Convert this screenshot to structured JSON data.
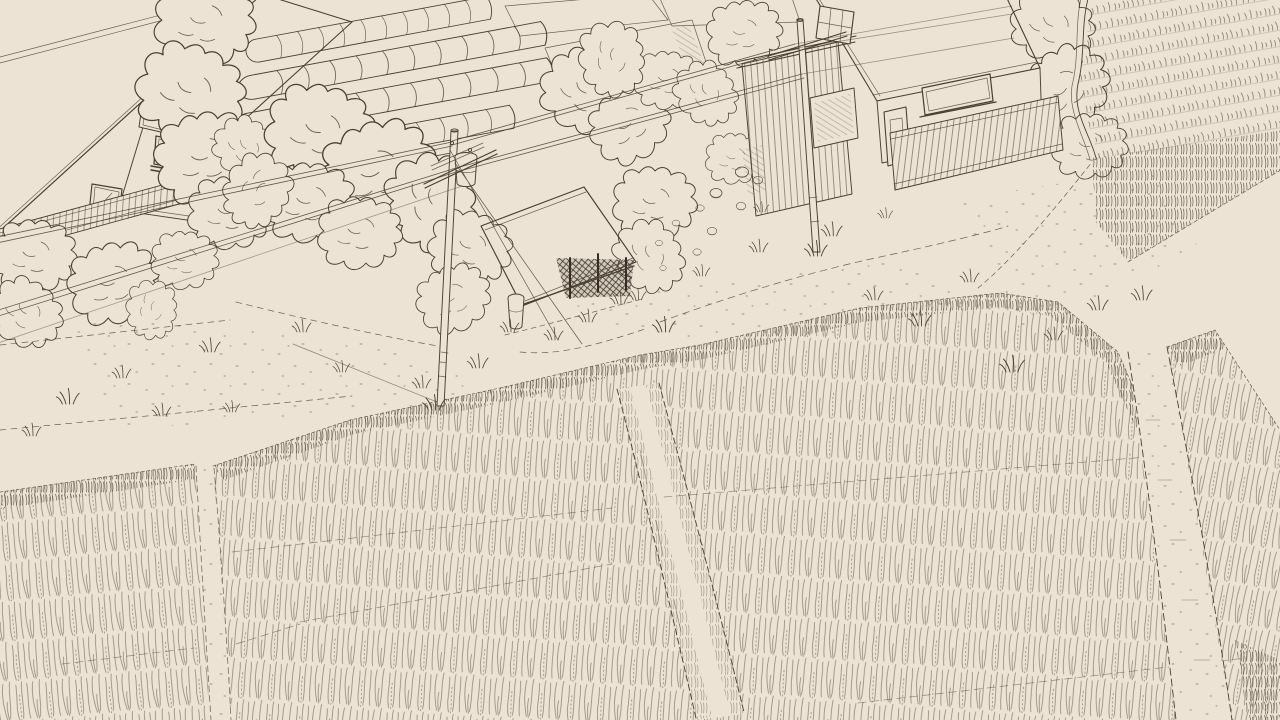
{
  "meta": {
    "kind": "hand-drawn sepia line-art illustration",
    "subject": "overhead rural scene: two houses, greenhouse tunnels, vegetable beds, utility poles with power lines, a small roadside shed, a curving road junction and large rice-paddy fields",
    "visible_text": "none"
  },
  "colors": {
    "background": "#ece3d5",
    "ink": "#4a3f33",
    "ink_dark": "#362e26",
    "ink_light": "#8b7b67"
  },
  "scene": {
    "elements": [
      "left-house",
      "greenhouse-tunnels",
      "vegetable-beds",
      "right-house",
      "plank-wall",
      "sign-board",
      "utility-pole-center",
      "utility-pole-right",
      "power-lines",
      "transformer",
      "storage-shed",
      "barrel",
      "bushes",
      "stones",
      "road",
      "road-branch",
      "stubble-field",
      "rice-paddy-left",
      "rice-paddy-main",
      "rice-paddy-right",
      "footpath",
      "drainage-ditch",
      "dirt-path",
      "grass-tufts",
      "furrow-lines"
    ]
  }
}
